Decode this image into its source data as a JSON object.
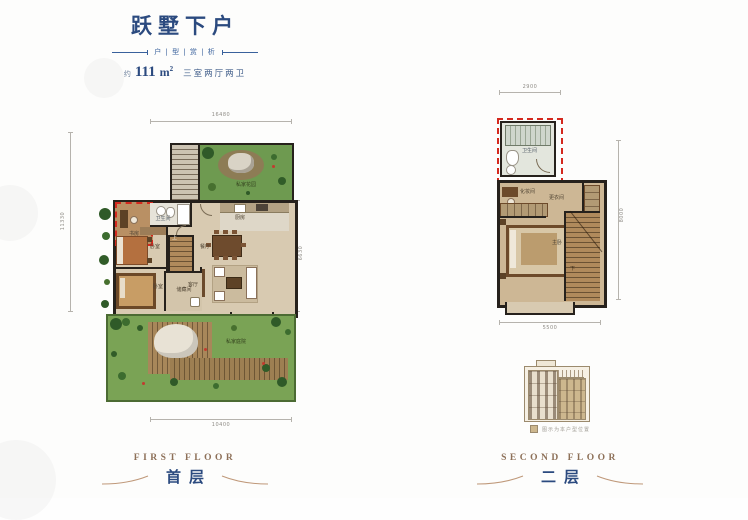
{
  "header": {
    "title": "跃墅下户",
    "tagline": "户 | 型 | 赏 | 析",
    "area_about": "约",
    "area_number": "111",
    "area_unit": "m",
    "area_exponent": "2",
    "spec": "三室两厅两卫"
  },
  "floor1": {
    "name_en": "FIRST FLOOR",
    "name_cn": "首层",
    "dimensions": {
      "top": "16480",
      "left": "11330",
      "right": "6630",
      "bottom": "10400"
    },
    "rooms": {
      "garden": "私家花园",
      "bathroom": "卫生间",
      "study": "书房",
      "bedroom_a": "卧室",
      "bedroom_b": "卧室",
      "storage": "储藏间",
      "dining": "餐厅",
      "living": "客厅",
      "kitchen": "厨房",
      "courtyard": "私家庭院",
      "stair_up": "上"
    }
  },
  "floor2": {
    "name_en": "SECOND FLOOR",
    "name_cn": "二层",
    "dimensions": {
      "top": "2900",
      "right": "8000",
      "bottom": "5500"
    },
    "rooms": {
      "bathroom": "卫生间",
      "vanity": "化妆间",
      "cloakroom": "更衣间",
      "master_bedroom": "主卧",
      "stair_down": "下"
    }
  },
  "elevation_legend": "图示为本户型位置",
  "colors": {
    "navy": "#2b4a7f",
    "taupe": "#8d7058",
    "wall": "#26211c",
    "highlight_red": "#d4281e",
    "garden_green": "#79a155",
    "floor_tan": "#d8cab1",
    "wood_brown": "#b08a5c"
  }
}
